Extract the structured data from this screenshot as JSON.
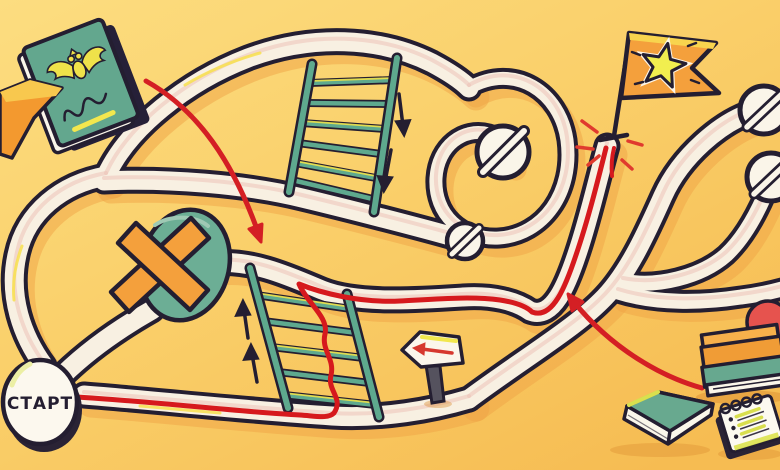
{
  "start": {
    "label": "СТАРТ"
  },
  "palette": {
    "background_top": "#FCDD80",
    "background_bottom": "#F6BC52",
    "path_cream": "#F8F0E2",
    "outline_dark": "#241E31",
    "teal": "#65A88F",
    "orange": "#F4A03C",
    "accent_yellow": "#F3E84F",
    "star_yellow": "#F1EE4F",
    "route_red": "#D6191D",
    "ball_red": "#E6534E",
    "post_gray": "#55525E"
  },
  "objects": [
    {
      "name": "passport-icon",
      "description": "teal passport with golden eagle emblem"
    },
    {
      "name": "start-circle",
      "label": "СТАРТ"
    },
    {
      "name": "maze-roads",
      "description": "winding cream roads with dead ends"
    },
    {
      "name": "ladder-icon",
      "count": 2
    },
    {
      "name": "no-entry-icon",
      "count": 4
    },
    {
      "name": "cross-mark-icon",
      "description": "orange X on teal badge"
    },
    {
      "name": "direction-arrow-icon",
      "count": 4
    },
    {
      "name": "signpost-icon",
      "description": "left-pointing sign with red arrow"
    },
    {
      "name": "goal-flag-icon",
      "description": "orange flag with yellow star"
    },
    {
      "name": "route-line",
      "color": "#D6191D"
    },
    {
      "name": "books-stack-icon",
      "description": "orange and teal books with red ball"
    },
    {
      "name": "notebook-icon"
    },
    {
      "name": "notepad-icon",
      "description": "spiral notepad with checklist"
    }
  ]
}
